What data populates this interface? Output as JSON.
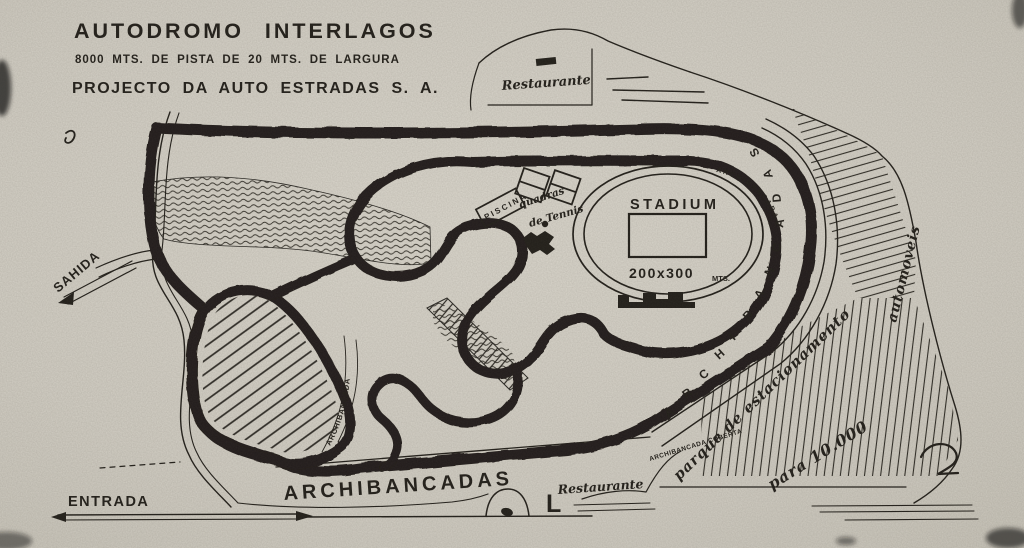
{
  "header": {
    "title": "AUTODROMO INTERLAGOS",
    "subtitle": "8000 MTS. DE PISTA DE 20 MTS. DE LARGURA",
    "project": "PROJECTO DA AUTO ESTRADAS S. A."
  },
  "gates": {
    "entrada": "ENTRADA",
    "sahida": "SAHIDA"
  },
  "landmarks": {
    "restaurante_top": "Restaurante",
    "restaurante_bottom": "Restaurante",
    "stadium": "STADIUM",
    "stadium_dimensions": "200x300",
    "stadium_unit": "MTS.",
    "piscina": "PISCINA",
    "tennis_line1": "quadras",
    "tennis_line2": "de Tennis",
    "l_mark": "L"
  },
  "stands": {
    "archibancadas_bottom": "ARCHIBANCADAS",
    "archibancada_coberta": "ARCHIBANCADA COBERTA",
    "archibancada_teardrop": "ARCHIBANCADA",
    "archibancada_stadium": "ARCHIBANCADA",
    "archibancadas_letters": [
      "A",
      "R",
      "C",
      "H",
      "I",
      "B",
      "A",
      "N",
      "C",
      "A",
      "D",
      "A",
      "S"
    ]
  },
  "parking": {
    "line1": "parque de estacionamento",
    "line2": "para 10.000",
    "line3": "automoveis"
  },
  "colors": {
    "paper": "#d5d1c7",
    "ink": "#221f1a"
  }
}
